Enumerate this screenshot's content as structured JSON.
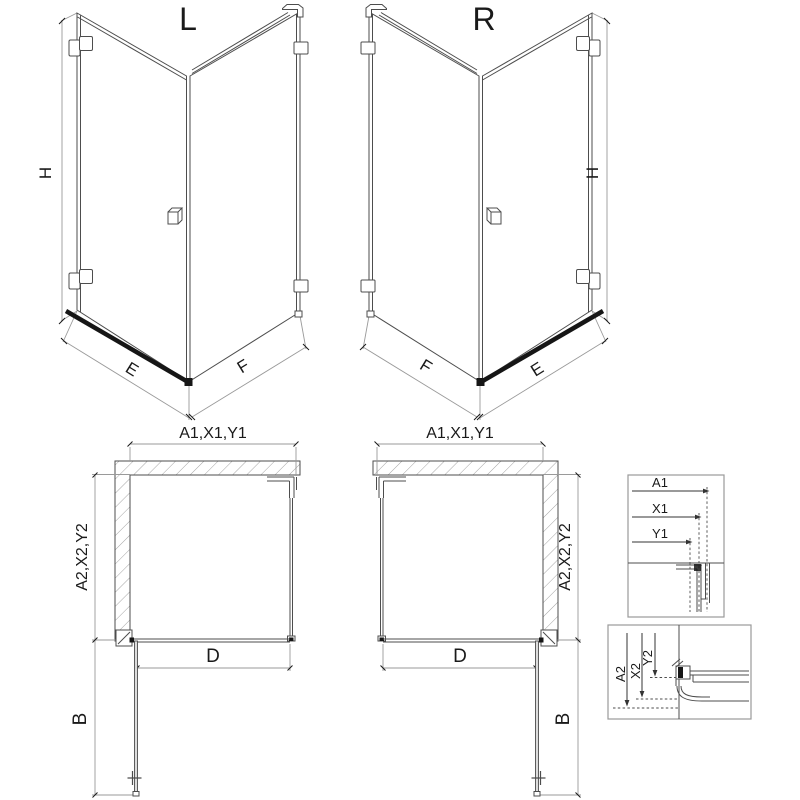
{
  "drawing": {
    "views": {
      "iso_left": {
        "title": "L",
        "dim_height": "H",
        "dim_door": "E",
        "dim_panel": "F"
      },
      "iso_right": {
        "title": "R",
        "dim_height": "H",
        "dim_door": "E",
        "dim_panel": "F"
      },
      "plan_left": {
        "dim_top": "A1,X1,Y1",
        "dim_side": "A2,X2,Y2",
        "dim_door": "D",
        "dim_open": "B"
      },
      "plan_right": {
        "dim_top": "A1,X1,Y1",
        "dim_side": "A2,X2,Y2",
        "dim_door": "D",
        "dim_open": "B"
      },
      "detail_wall": {
        "dims": [
          "A1",
          "X1",
          "Y1"
        ]
      },
      "detail_floor": {
        "dims": [
          "A2",
          "X2",
          "Y2"
        ]
      }
    },
    "colors": {
      "line": "#4d4d4d",
      "dim_line": "#9a9a9a",
      "hatch": "#9a9a9a",
      "threshold": "#161616",
      "label": "#1a1a1a",
      "glass": "#dcdcdc"
    }
  }
}
